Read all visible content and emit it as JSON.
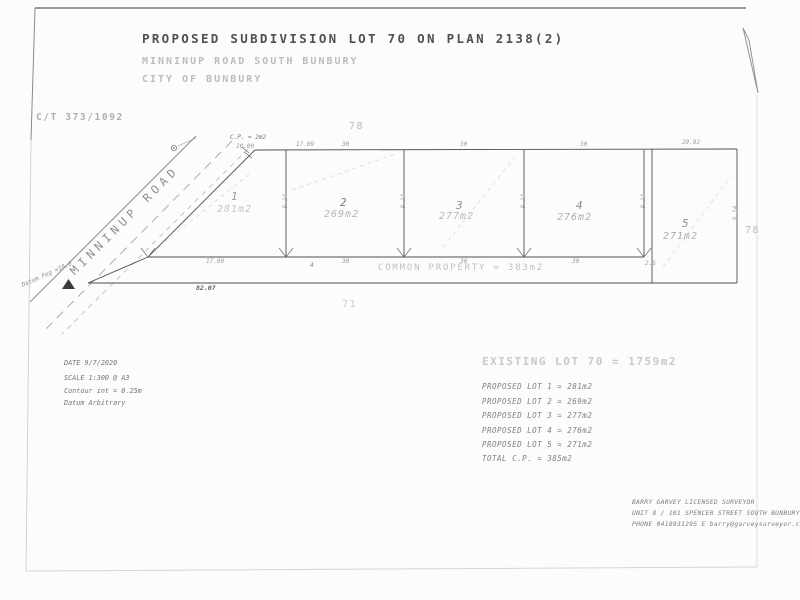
{
  "title_block": {
    "title": "PROPOSED SUBDIVISION LOT 70 ON PLAN 2138(2)",
    "subtitle_road": "MINNINUP ROAD SOUTH BUNBURY",
    "subtitle_city": "CITY OF BUNBURY"
  },
  "certificate_of_title": "C/T 373/1092",
  "road_label": "MINNINUP ROAD",
  "datum_peg_label": "Datum Peg =10.0",
  "corner_note": {
    "cp_label": "C.P. = 2m2",
    "dim": "10.00"
  },
  "lots": [
    {
      "number": "1",
      "area": "281m2",
      "top_dim": "17.09",
      "bottom_dim": "17.09",
      "side_dim": "9.14"
    },
    {
      "number": "2",
      "area": "269m2",
      "top_dim": "30",
      "bottom_dim": "30",
      "side_dim": "9.14"
    },
    {
      "number": "3",
      "area": "277m2",
      "top_dim": "30",
      "bottom_dim": "30",
      "side_dim": "9.14"
    },
    {
      "number": "4",
      "area": "276m2",
      "top_dim": "30",
      "bottom_dim": "30",
      "side_dim": "9.14"
    },
    {
      "number": "5",
      "area": "271m2",
      "top_dim": "29.92",
      "bottom_dim": "2.5",
      "side_dim": "9.14"
    }
  ],
  "neighbours": {
    "top": "78",
    "right": "78",
    "bottom": "71"
  },
  "common_property": {
    "width_dim": "4",
    "label": "COMMON PROPERTY = 383m2",
    "overall_dim": "82.07"
  },
  "legend": {
    "date": "DATE 9/7/2020",
    "scale": "SCALE 1:300 @ A3",
    "contour": "Contour int = 0.25m",
    "datum": "Datum Arbitrary"
  },
  "schedule": {
    "existing": "EXISTING LOT 70 = 1759m2",
    "rows": [
      "PROPOSED LOT 1 = 281m2",
      "PROPOSED LOT 2 = 269m2",
      "PROPOSED LOT 3 = 277m2",
      "PROPOSED LOT 4 = 276m2",
      "PROPOSED LOT 5 = 271m2"
    ],
    "total": "TOTAL C.P. = 385m2"
  },
  "surveyor": {
    "name": "BARRY GARVEY LICENSED SURVEYOR",
    "address": "UNIT 8 / 101 SPENCER STREET SOUTH BUNBURY",
    "contact": "PHONE 0418931295 E barry@garveysurveyor.com"
  },
  "colors": {
    "paper": "#fcfcfa",
    "ink": "#4a4a4a",
    "faint_ink": "#b5b5b5"
  }
}
